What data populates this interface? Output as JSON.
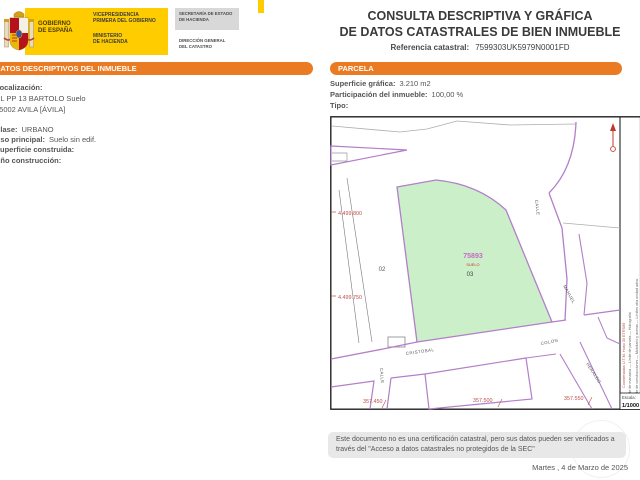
{
  "header": {
    "logo": {
      "gobierno_l1": "GOBIERNO",
      "gobierno_l2": "DE ESPAÑA",
      "vice_l1": "VICEPRESIDENCIA",
      "vice_l2": "PRIMERA DEL GOBIERNO",
      "min_l1": "MINISTERIO",
      "min_l2": "DE HACIENDA",
      "sec_l1": "SECRETARÍA DE ESTADO",
      "sec_l2": "DE HACIENDA",
      "dir_l1": "DIRECCIÓN GENERAL",
      "dir_l2": "DEL CATASTRO"
    },
    "title_l1": "CONSULTA DESCRIPTIVA Y GRÁFICA",
    "title_l2": "DE DATOS CATASTRALES DE BIEN INMUEBLE",
    "ref_label": "Referencia catastral:",
    "ref_value": "7599303UK5979N0001FD"
  },
  "inmueble": {
    "panel_title": "DATOS DESCRIPTIVOS DEL INMUEBLE",
    "localizacion_label": "Localización:",
    "direccion": "CL PP 13 BARTOLO  Suelo",
    "municipio": "05002 AVILA [ÁVILA]",
    "clase_label": "Clase:",
    "clase": "URBANO",
    "uso_label": "Uso principal:",
    "uso": "Suelo sin edif.",
    "superficie_label": "Superficie construida:",
    "superficie": "",
    "anio_label": "Año construcción:",
    "anio": ""
  },
  "parcela": {
    "panel_title": "PARCELA",
    "superficie_label": "Superficie gráfica:",
    "superficie": "3.210 m2",
    "participacion_label": "Participación del inmueble:",
    "participacion": "100,00 %",
    "tipo_label": "Tipo:",
    "tipo": ""
  },
  "map": {
    "parcel_number": "75893",
    "parcel_use": "SUELO",
    "parcel_code": "03",
    "adjacent_parcel": "02",
    "coords": {
      "y1": "4.499.800",
      "y2": "4.499.750",
      "x1": "357.450",
      "x2": "357.500",
      "x3": "357.550"
    },
    "streets": {
      "calle_top": "CALLE",
      "cristobal": "CRISTOBAL",
      "colon": "COLON",
      "calle_bottom": "CALLE",
      "manuel": "MANUEL",
      "heraldo": "HERALDO"
    },
    "legend_col1": "— Límite de manzana     — Límite de parcela     — Hidrografía",
    "legend_col2": "— Límite de construcciones     — Mobiliario y aceras     — Límites otra unidad adva.",
    "utm_note": "Coordenadas U.T.M. Huso 30 ETRS89",
    "escala_label": "Escala:",
    "escala_value": "1/1000",
    "colors": {
      "parcel_fill": "#CBEFC8",
      "line_purple": "#B27FC8",
      "coord_red": "#C0504D",
      "parcel_number_color": "#C869C8",
      "section_orange": "#EB7B22",
      "gov_yellow": "#FFCC00"
    }
  },
  "footer": {
    "disclaimer": "Este documento no es una certificación catastral, pero sus datos pueden ser verificados a través del \"Acceso a datos catastrales no protegidos de la SEC\"",
    "date": "Martes , 4 de Marzo de 2025"
  }
}
